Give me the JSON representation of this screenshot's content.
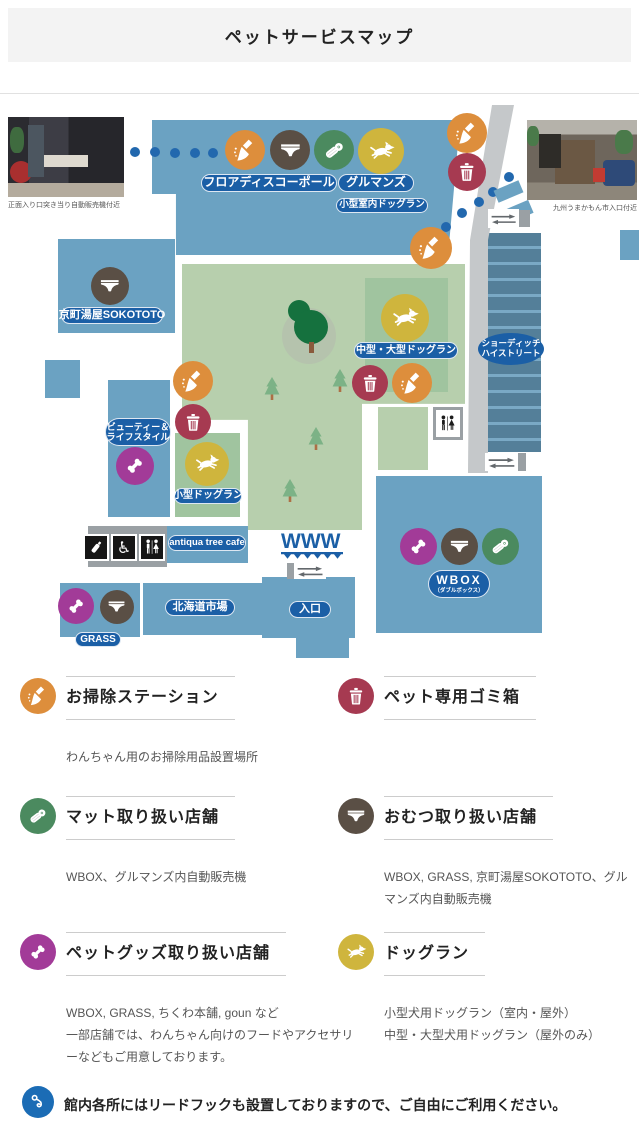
{
  "page": {
    "title": "ペットサービスマップ"
  },
  "map": {
    "photos": [
      {
        "caption": "正面入り口突き当り自動販売機付近"
      },
      {
        "caption": "九州うまかもん市入口付近"
      }
    ],
    "labels": {
      "floor_disco": "フロアディスコーポール",
      "gourmands": "グルマンズ",
      "indoor_small_dogrun": "小型室内ドッグラン",
      "kyomachi": "京町湯屋SOKOTOTO",
      "beauty_line1": "ビューティー＆",
      "beauty_line2": "ライフスタイル",
      "mid_large_dogrun": "中型・大型ドッグラン",
      "shoreditch_line1": "ショーディッチ",
      "shoreditch_line2": "ハイストリート",
      "small_dogrun": "小型ドッグラン",
      "antiqua": "antiqua tree cafe",
      "wbox": "WBOX",
      "wbox_sub": "（ダブルボックス）",
      "hokkaido": "北海道市場",
      "entrance": "入口",
      "grass": "GRASS",
      "www": "WWW"
    }
  },
  "legend": {
    "items": [
      {
        "icon": "broom-icon",
        "color": "#dd8e3c",
        "title": "お掃除ステーション",
        "desc": "わんちゃん用のお掃除用品設置場所"
      },
      {
        "icon": "trash-icon",
        "color": "#a63a51",
        "title": "ペット専用ゴミ箱",
        "desc": ""
      },
      {
        "icon": "mat-icon",
        "color": "#4b8a5f",
        "title": "マット取り扱い店舗",
        "desc": "WBOX、グルマンズ内自動販売機"
      },
      {
        "icon": "diaper-icon",
        "color": "#5a4f45",
        "title": "おむつ取り扱い店舗",
        "desc": "WBOX, GRASS, 京町湯屋SOKOTOTO、グルマンズ内自動販売機"
      },
      {
        "icon": "bone-icon",
        "color": "#a23b98",
        "title": "ペットグッズ取り扱い店舗",
        "desc": "WBOX, GRASS, ちくわ本舗, goun など\n一部店舗では、わんちゃん向けのフードやアクセサリーなどもご用意しております。"
      },
      {
        "icon": "dog-icon",
        "color": "#cfb53d",
        "title": "ドッグラン",
        "desc": "小型犬用ドッグラン（室内・屋外）\n中型・大型犬用ドッグラン（屋外のみ）"
      }
    ],
    "note": "館内各所にはリードフックも設置しておりますので、ご自由にご利用ください。"
  },
  "colors": {
    "c-blue": "#6ba2c2",
    "c-pill": "#1b5fa6",
    "c-green1": "#b7cfad",
    "c-green2": "#a0c49f",
    "c-road": "#c5c8ca",
    "c-orange": "#dd8e3c",
    "c-brown": "#5a4f45",
    "c-matgreen": "#4b8a5f",
    "c-yellow": "#cfb53d",
    "c-purple": "#a23b98",
    "c-red": "#a63a51",
    "c-dot": "#2268ae",
    "c-note": "#1b6cb5"
  }
}
